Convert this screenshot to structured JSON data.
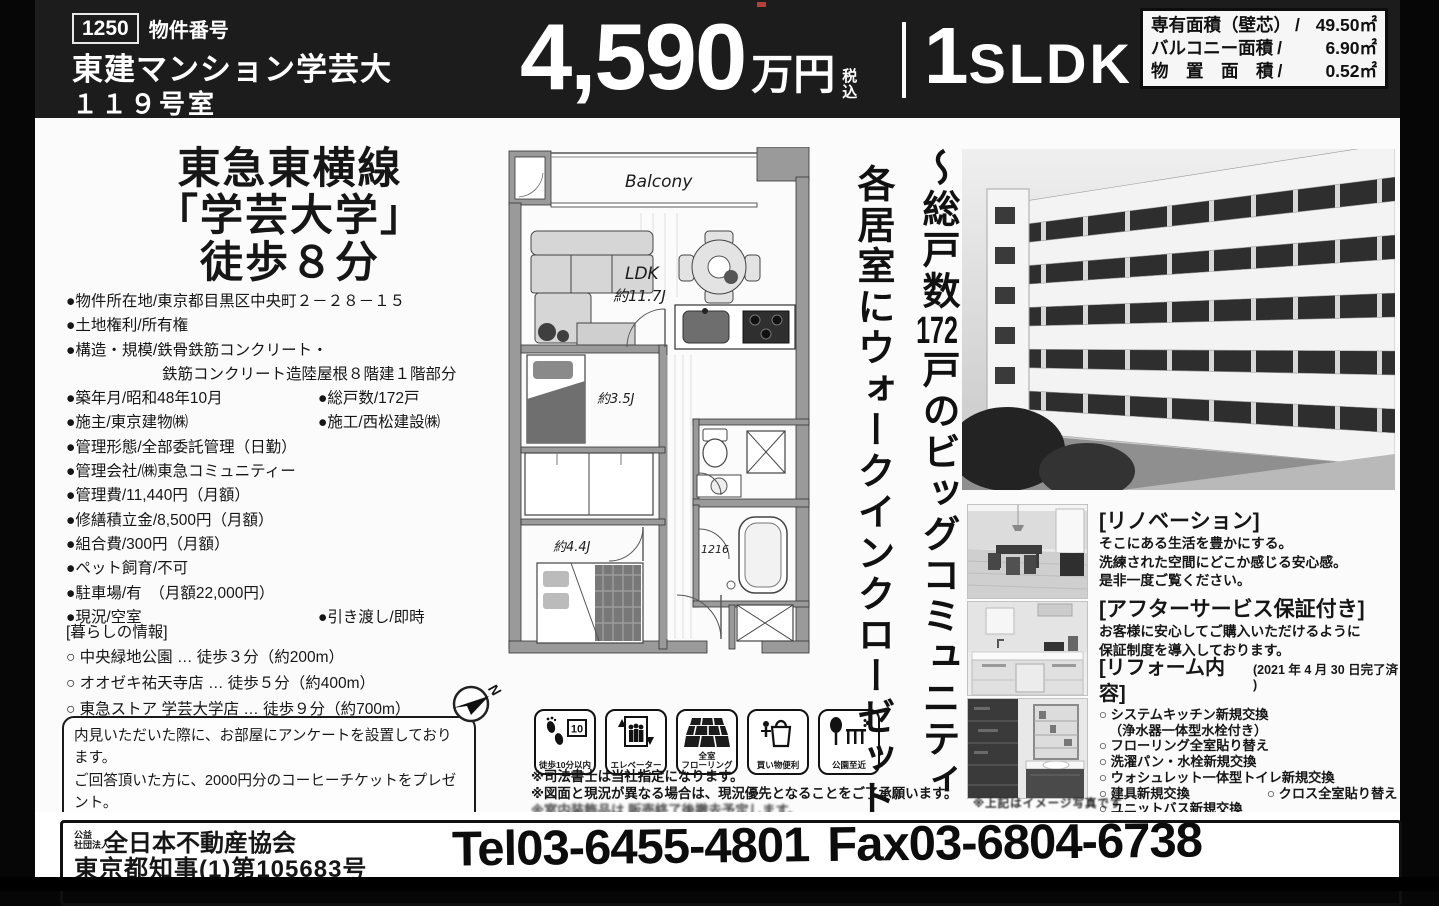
{
  "colors": {
    "header_bg": "#1c1c1c",
    "paper": "#fbfbfb",
    "ink": "#161616"
  },
  "header": {
    "id_value": "1250",
    "id_label": "物件番号",
    "name": "東建マンション学芸大",
    "room": "１１９号室",
    "price": "4,590",
    "price_unit": "万円",
    "tax_1": "税",
    "tax_2": "込",
    "layout_num": "1",
    "layout_letters": "SLDK",
    "areas": [
      {
        "label": "専有面積（壁芯）",
        "slash": "/",
        "value": "49.50㎡"
      },
      {
        "label": "バルコニー面積",
        "slash": "/",
        "value": "6.90㎡"
      },
      {
        "label": "物　置　面　積",
        "slash": "/",
        "value": "0.52㎡"
      }
    ]
  },
  "access": {
    "line1": "東急東横線",
    "line2": "「学芸大学」",
    "line3": "徒歩８分"
  },
  "details": {
    "rows": [
      {
        "l": "●物件所在地/東京都目黒区中央町２－２８－１５"
      },
      {
        "l": "●土地権利/所有権"
      },
      {
        "l": "●構造・規模/鉄骨鉄筋コンクリート・"
      },
      {
        "l": "鉄筋コンクリート造陸屋根８階建１階部分"
      },
      {
        "l": "●築年月/昭和48年10月",
        "r": "●総戸数/172戸"
      },
      {
        "l": "●施主/東京建物㈱",
        "r": "●施工/西松建設㈱"
      },
      {
        "l": "●管理形態/全部委託管理（日勤）"
      },
      {
        "l": "●管理会社/㈱東急コミュニティー"
      },
      {
        "l": "●管理費/11,440円（月額）"
      },
      {
        "l": "●修繕積立金/8,500円（月額）"
      },
      {
        "l": "●組合費/300円（月額）"
      },
      {
        "l": "●ペット飼育/不可"
      },
      {
        "l": "●駐車場/有　（月額22,000円）"
      },
      {
        "l": "●現況/空室",
        "r": "●引き渡し/即時"
      }
    ]
  },
  "living": {
    "title": "[暮らしの情報]",
    "items": [
      "○ 中央緑地公園 … 徒歩３分（約200m）",
      "○ オオゼキ祐天寺店 … 徒歩５分（約400m）",
      "○ 東急ストア 学芸大学店 … 徒歩９分（約700m）"
    ]
  },
  "survey": {
    "lines": [
      "内見いただいた際に、お部屋にアンケートを設置しております。",
      "ご回答頂いた方に、2000円分のコーヒーチケットをプレゼント。",
      "アンケートはQRコードで簡単にお答え頂けます。",
      "内見時にアンケートをご覧下さい。　（※完成物件のみ）"
    ]
  },
  "floorplan": {
    "balcony": "Balcony",
    "ldk": "LDK",
    "ldk_size": "約11.7J",
    "room_a": "約3.5J",
    "room_b": "約4.4J",
    "bath": "1216",
    "north": "N"
  },
  "features": {
    "items": [
      {
        "label": "徒歩10分以内",
        "badge": "10"
      },
      {
        "label": "エレベーター"
      },
      {
        "label": "全室\nフローリング"
      },
      {
        "label": "買い物便利"
      },
      {
        "label": "公園至近"
      }
    ]
  },
  "notes": {
    "lines": [
      "※司法書士は当社指定になります。",
      "※図面と現況が異なる場合は、現況優先となることをご了承願います。",
      "※室内装飾品は 販売終了後撤去予定します。"
    ]
  },
  "catch": {
    "line1_pre": "〜総戸数",
    "line1_num": "172",
    "line1_post": "戸のビッグコミュニティ",
    "line2": "各居室にウォークインクローゼット〜"
  },
  "right": {
    "renovation_title": "[リノベーション]",
    "renovation_lines": [
      "そこにある生活を豊かにする。",
      "洗練された空間にどこか感じる安心感。",
      "是非一度ご覧ください。"
    ],
    "service_title": "[アフターサービス保証付き]",
    "service_lines": [
      "お客様に安心してご購入いただけるように",
      "保証制度を導入しております。"
    ],
    "reform_title": "[リフォーム内容]",
    "reform_date": "(2021 年 4 月 30 日完了済 )",
    "reform_rows": [
      {
        "l": "○ システムキッチン新規交換"
      },
      {
        "l": "（浄水器一体型水栓付き）"
      },
      {
        "l": "○ フローリング全室貼り替え"
      },
      {
        "l": "○ 洗濯パン・水栓新規交換"
      },
      {
        "l": "○ ウォシュレット一体型トイレ新規交換"
      },
      {
        "l": "○ 建具新規交換",
        "r": "○ クロス全室貼り替え"
      },
      {
        "l": "○ ユニットバス新規交換"
      },
      {
        "l": "○ 洗面化粧台新規交換"
      },
      {
        "l": "○ ルームクリーニング　等"
      }
    ],
    "photo_caption": "※上記はイメージ写真です"
  },
  "footer": {
    "org_class_1": "公益",
    "org_class_2": "社団法人",
    "org": "全日本不動産協会",
    "license": "東京都知事(1)第105683号",
    "tel": "Tel03-6455-4801",
    "fax": "Fax03-6804-6738"
  }
}
